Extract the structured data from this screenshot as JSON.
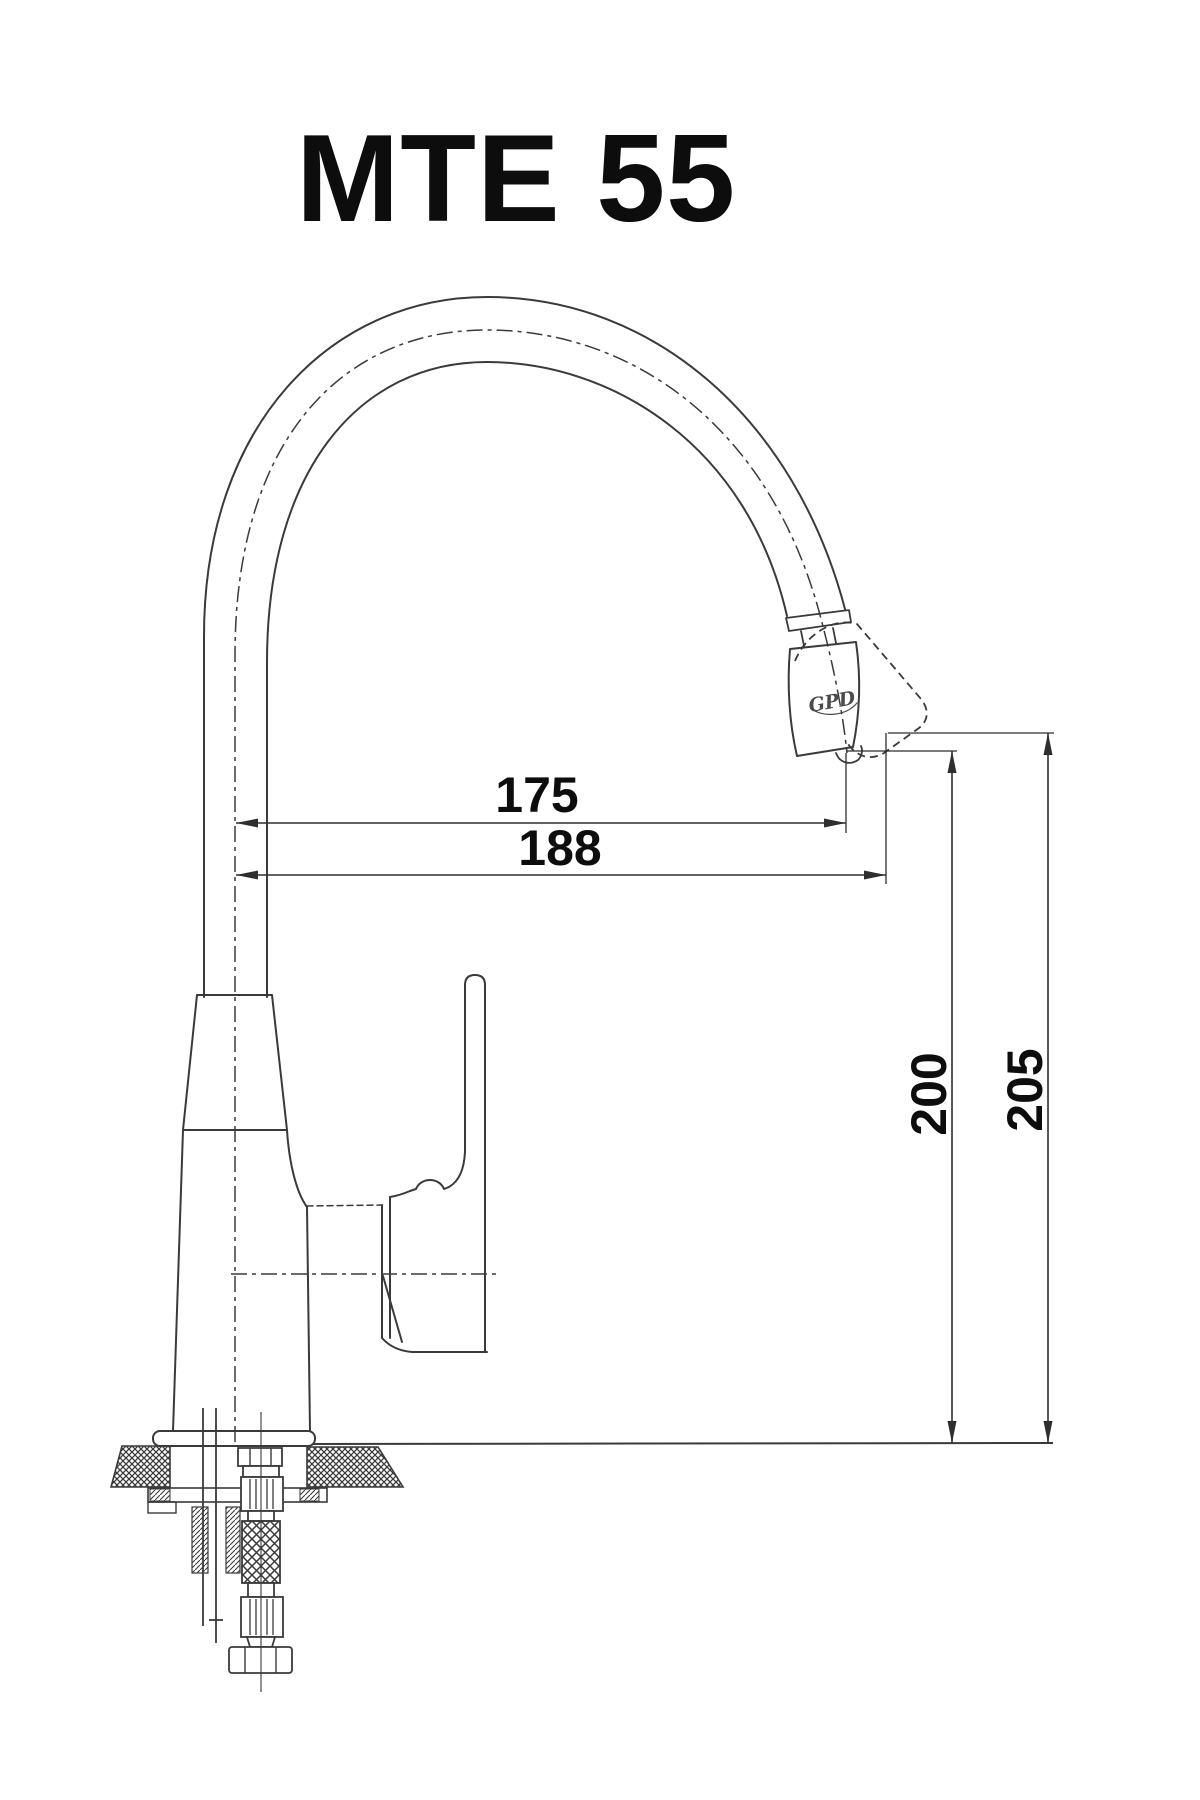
{
  "page": {
    "background": "#ffffff",
    "line_color": "#3a3a3a",
    "text_color": "#0d0d0d"
  },
  "drawing": {
    "title": "MTE 55",
    "product": {
      "brand_logo": "GPD"
    },
    "dimension_labels": {
      "reach_to_aerator_mm": "175",
      "reach_to_tip_mm": "188",
      "height_to_aerator_mm": "200",
      "height_to_tip_mm": "205"
    }
  }
}
